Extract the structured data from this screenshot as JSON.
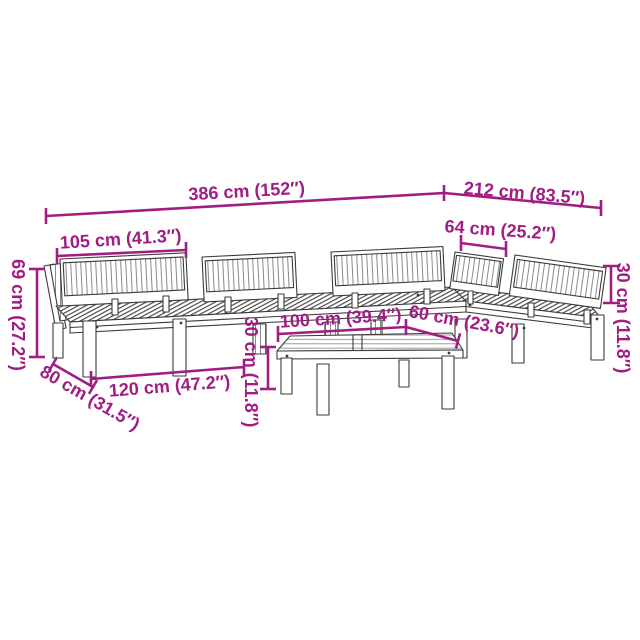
{
  "figure": {
    "kind": "product-dimension-diagram",
    "subject": "garden-pallet-sofa-set-with-coffee-table",
    "colors": {
      "dimension_accent": "#A01D82",
      "line_art": "#3B3B3B",
      "background": "#FFFFFF"
    }
  },
  "dimensions": {
    "total_length": "386 cm (152″)",
    "side_length": "212 cm (83.5″)",
    "backrest_width": "105 cm (41.3″)",
    "corner_backrest_width": "64 cm (25.2″)",
    "backrest_height": "30 cm (11.8″)",
    "total_height": "69 cm (27.2″)",
    "seat_depth": "80 cm (31.5″)",
    "sofa_length": "120 cm (47.2″)",
    "table_height": "30 cm (11.8″)",
    "table_length": "100 cm (39.4″)",
    "table_depth": "60 cm (23.6″)"
  }
}
